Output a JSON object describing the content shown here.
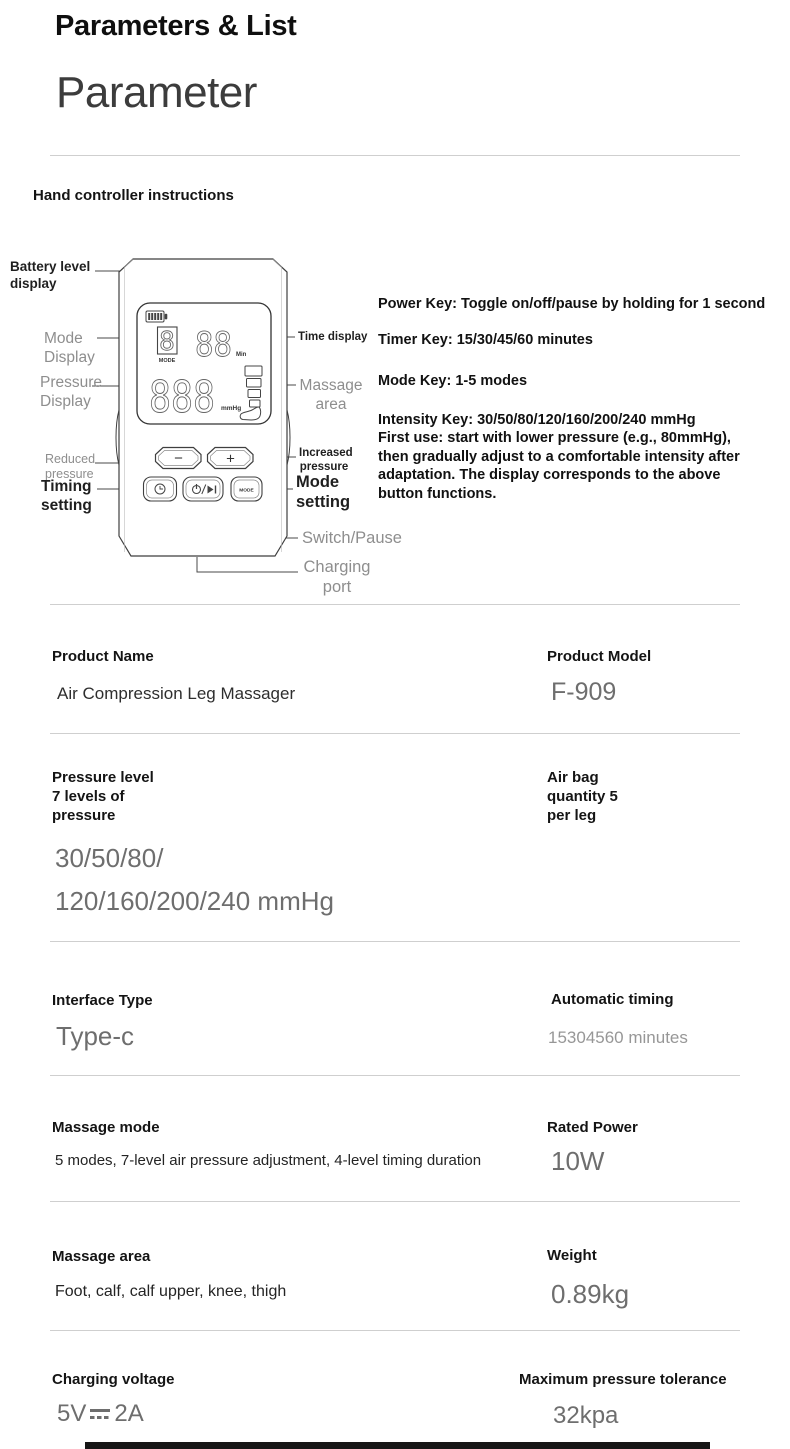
{
  "header": {
    "title": "Parameters & List",
    "subtitle": "Parameter",
    "section_heading": "Hand controller instructions"
  },
  "controller": {
    "screen": {
      "mode_digit": "8",
      "mode_caption": "MODE",
      "time_digits": "88",
      "time_unit": "Min",
      "pressure_digits": "888",
      "pressure_unit": "mmHg"
    },
    "buttons": {
      "decrease": "−",
      "increase": "+",
      "mode": "MODE"
    },
    "labels": {
      "battery": "Battery level\ndisplay",
      "mode_display": "Mode\nDisplay",
      "pressure_display": "Pressure\nDisplay",
      "reduced_pressure": "Reduced\npressure",
      "timing_setting": "Timing\nsetting",
      "time_display": "Time display",
      "massage_area": "Massage\narea",
      "increased_pressure": "Increased\npressure",
      "mode_setting": "Mode\nsetting",
      "switch_pause": "Switch/Pause",
      "charging_port": "Charging\nport"
    }
  },
  "instructions": {
    "power_key": "Power Key: Toggle on/off/pause by holding for 1 second",
    "timer_key": "Timer Key: 15/30/45/60 minutes",
    "mode_key": "Mode Key: 1-5 modes",
    "intensity_key": "Intensity Key: 30/50/80/120/160/200/240 mmHg",
    "first_use": "First use: start with lower pressure (e.g., 80mmHg),\nthen gradually adjust to a comfortable intensity after\nadaptation. The display corresponds to the above\nbutton functions."
  },
  "specs": {
    "product_name": {
      "label": "Product Name",
      "value": "Air Compression Leg Massager"
    },
    "product_model": {
      "label": "Product Model",
      "value": "F-909"
    },
    "pressure_level": {
      "label": "Pressure level\n7 levels of\npressure",
      "value_line1": "30/50/80/",
      "value_line2": "120/160/200/240 mmHg"
    },
    "air_bag": {
      "label": "Air bag\nquantity 5\nper leg"
    },
    "interface_type": {
      "label": "Interface Type",
      "value": "Type-c"
    },
    "automatic_timing": {
      "label": "Automatic timing",
      "value": "15304560 minutes"
    },
    "massage_mode": {
      "label": "Massage mode",
      "value": "5 modes, 7-level air pressure adjustment, 4-level timing duration"
    },
    "rated_power": {
      "label": "Rated Power",
      "value": "10W"
    },
    "massage_area": {
      "label": "Massage area",
      "value": "Foot, calf, calf upper, knee, thigh"
    },
    "weight": {
      "label": "Weight",
      "value": "0.89kg"
    },
    "charging_voltage": {
      "label": "Charging voltage",
      "value_volts": "5V",
      "value_amps": "2A"
    },
    "max_pressure": {
      "label": "Maximum pressure tolerance",
      "value": "32kpa"
    }
  },
  "colors": {
    "label_dark": "#141414",
    "value_gray": "#6e6e6e",
    "diagram_gray": "#8e8e8e",
    "divider": "#cfcfcf"
  }
}
